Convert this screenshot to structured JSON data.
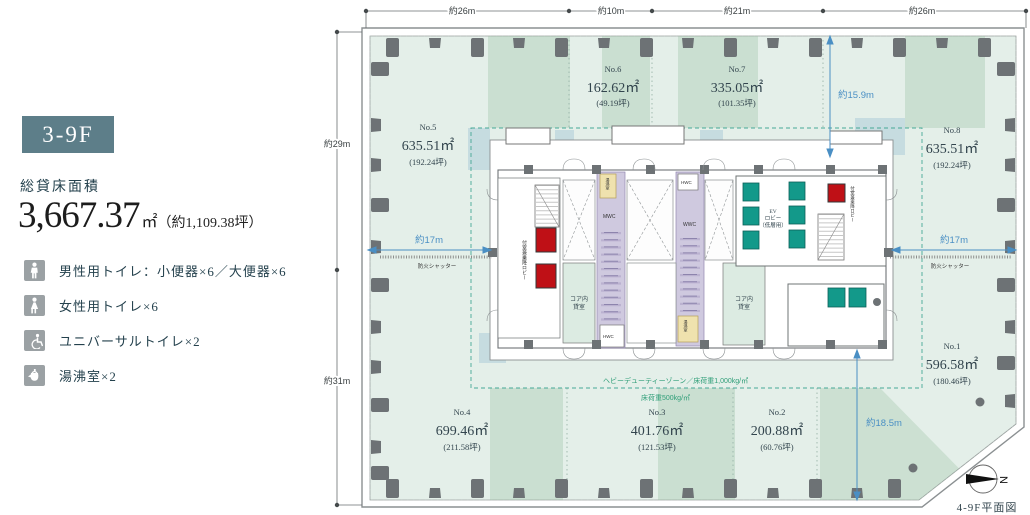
{
  "panel": {
    "badge": "3-9F",
    "area_label": "総貸床面積",
    "area_value": "3,667.37",
    "area_unit": "㎡",
    "area_paren": "（約1,109.38坪）",
    "facilities": [
      {
        "icon": "male-icon",
        "label": "男性用トイレ：小便器×6／大便器×6"
      },
      {
        "icon": "female-icon",
        "label": "女性用トイレ×6"
      },
      {
        "icon": "accessibility-icon",
        "label": "ユニバーサルトイレ×2"
      },
      {
        "icon": "kettle-icon",
        "label": "湯沸室×2"
      }
    ]
  },
  "plan": {
    "dims": {
      "top": [
        "約26m",
        "約10m",
        "約21m",
        "約26m"
      ],
      "left_top": "約29m",
      "left_bottom": "約31m",
      "core_top": "約15.9m",
      "span_left": "約17m",
      "span_right": "約17m",
      "core_bottom": "約18.5m"
    },
    "fire_shutter": "防火シャッター",
    "zones": {
      "heavy": "ヘビーデューティーゾーン／床荷重1,000kg/㎡",
      "normal": "床荷重500kg/㎡"
    },
    "rooms": [
      {
        "no": "No.1",
        "area": "596.58㎡",
        "tsubo": "(180.46坪)"
      },
      {
        "no": "No.2",
        "area": "200.88㎡",
        "tsubo": "(60.76坪)"
      },
      {
        "no": "No.3",
        "area": "401.76㎡",
        "tsubo": "(121.53坪)"
      },
      {
        "no": "No.4",
        "area": "699.46㎡",
        "tsubo": "(211.58坪)"
      },
      {
        "no": "No.5",
        "area": "635.51㎡",
        "tsubo": "(192.24坪)"
      },
      {
        "no": "No.6",
        "area": "162.62㎡",
        "tsubo": "(49.19坪)"
      },
      {
        "no": "No.7",
        "area": "335.05㎡",
        "tsubo": "(101.35坪)"
      },
      {
        "no": "No.8",
        "area": "635.51㎡",
        "tsubo": "(192.24坪)"
      }
    ],
    "core": {
      "vestibule": "付室兼乗降ロビー",
      "mwc": "MWC",
      "wwc": "WWC",
      "hwc": "HWC",
      "kettle_room": "湯沸室",
      "core_rent_l1": "コア内",
      "core_rent_l2": "貸室",
      "ev_l1": "EV",
      "ev_l2": "ロビー",
      "ev_l3": "（低層用）"
    },
    "compass_n": "N",
    "caption": "4-9F平面図"
  }
}
